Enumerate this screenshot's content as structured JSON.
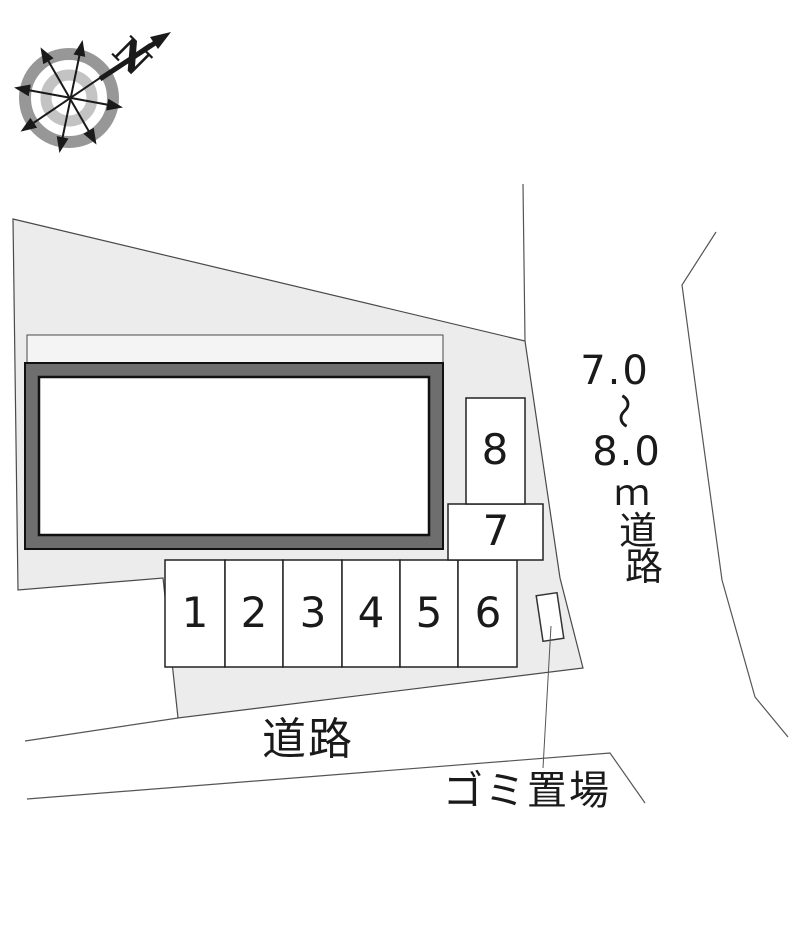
{
  "diagram": {
    "type": "real-estate site layout plan",
    "compass": {
      "north_label": "N"
    },
    "parking_spaces": [
      {
        "label": "1"
      },
      {
        "label": "2"
      },
      {
        "label": "3"
      },
      {
        "label": "4"
      },
      {
        "label": "5"
      },
      {
        "label": "6"
      },
      {
        "label": "7"
      },
      {
        "label": "8"
      }
    ],
    "labels": {
      "right_road_full": "7.0〜8.0ｍ道路",
      "right_road_chars": [
        "7.0",
        "〜",
        "8.0",
        "ｍ",
        "道",
        "路"
      ],
      "bottom_road": "道路",
      "garbage_area": "ゴミ置場"
    },
    "colors": {
      "site_fill": "#ececec",
      "walkway_fill": "#f4f4f4",
      "building_border": "#6e6e6e",
      "building_fill": "#ffffff",
      "boundary_line": "#4a4a4a",
      "compass_outer_ring": "#979797",
      "compass_inner_ring": "#c3c3c3"
    }
  }
}
